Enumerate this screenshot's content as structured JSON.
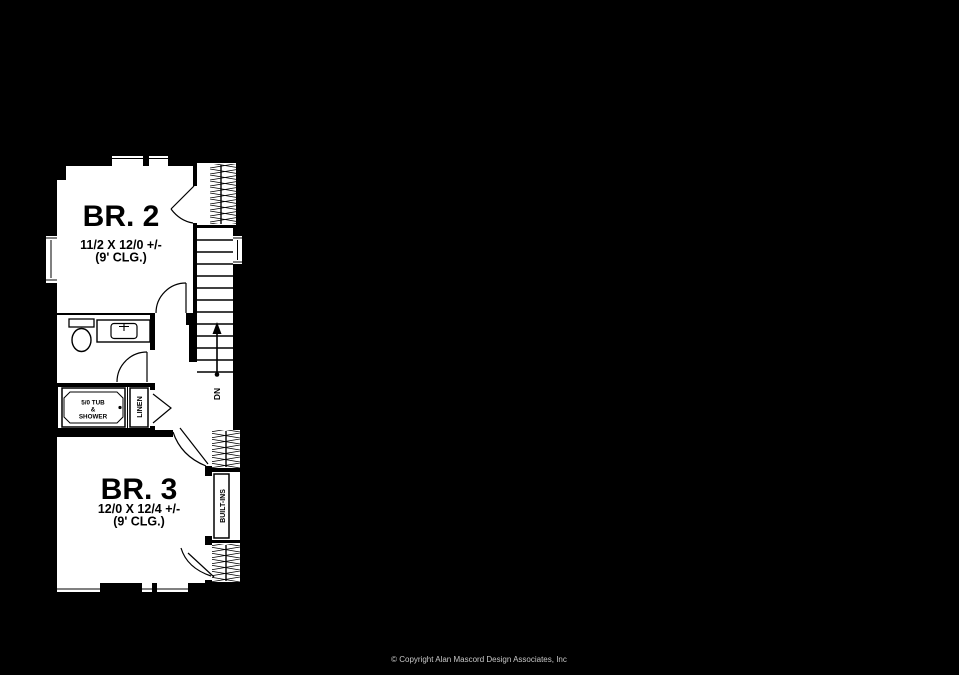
{
  "plan": {
    "br2": {
      "name": "BR. 2",
      "dims": "11/2 X 12/0 +/-",
      "clg": "(9' CLG.)"
    },
    "br3": {
      "name": "BR. 3",
      "dims": "12/0 X 12/4 +/-",
      "clg": "(9' CLG.)"
    },
    "bath": {
      "tub_line1": "5/0 TUB",
      "tub_line2": "&",
      "tub_line3": "SHOWER",
      "linen": "LINEN"
    },
    "builtins": "BUILT-INS",
    "stairs": {
      "dn": "DN"
    },
    "colors": {
      "background": "#000000",
      "floor": "#ffffff",
      "lines": "#000000",
      "copyright_text": "#c8c8c8"
    }
  },
  "footer": {
    "copyright": "© Copyright Alan Mascord Design Associates, Inc"
  }
}
